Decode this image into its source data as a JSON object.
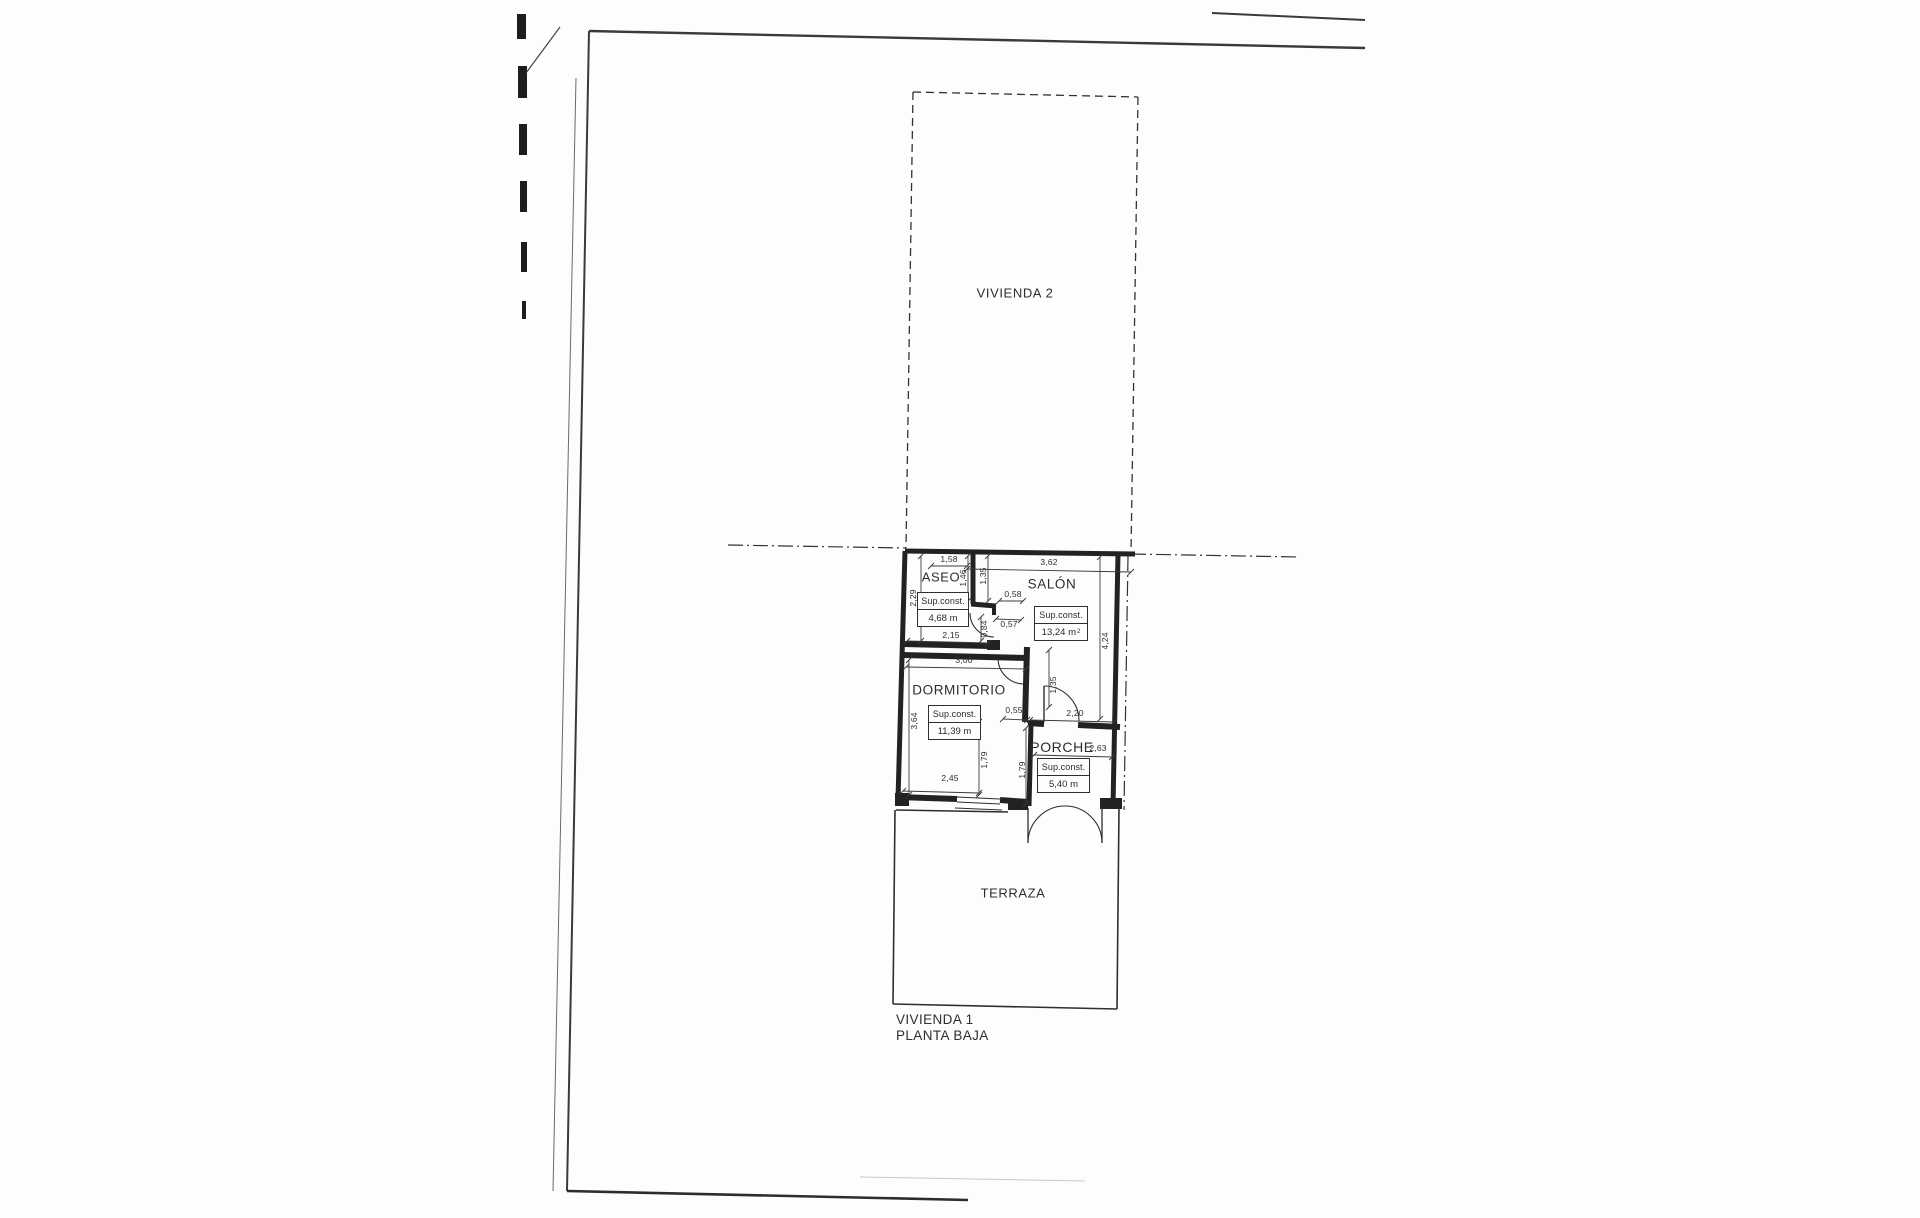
{
  "plan": {
    "upper_unit_label": "VIVIENDA 2",
    "footer": {
      "line1": "VIVIENDA 1",
      "line2": "PLANTA BAJA"
    },
    "sup_label": "Sup.const.",
    "rooms": {
      "aseo": {
        "name": "ASEO",
        "sup_label": "Sup.const.",
        "area": "4,68 m"
      },
      "salon": {
        "name": "SALÓN",
        "sup_label": "Sup.const.",
        "area": "13,24 m",
        "area_exponent": "2"
      },
      "dormitorio": {
        "name": "DORMITORIO",
        "sup_label": "Sup.const.",
        "area": "11,39 m"
      },
      "porche": {
        "name": "PORCHE",
        "sup_label": "Sup.const.",
        "area": "5,40 m"
      },
      "terraza": {
        "name": "TERRAZA"
      }
    },
    "dimensions": {
      "aseo_width": "1,58",
      "salon_width": "3,62",
      "aseo_height": "2,29",
      "aseo_partition_a": "1,46",
      "aseo_partition_b": "1,35",
      "hall_jog_top": "0,58",
      "hall_jog_bottom": "0,57",
      "aseo_door": "0,84",
      "aseo_inner_width": "2,15",
      "salon_height": "4,24",
      "dormitorio_width": "3,00",
      "dormitorio_height": "3,64",
      "hall_stub": "0,55",
      "porche_opening": "2,20",
      "salon_door": "1,35",
      "dormitorio_wall_a": "1,79",
      "porche_wall_b": "1,79",
      "dormitorio_inner_width": "2,45",
      "porche_width": "2,63"
    },
    "colors": {
      "ink": "#2b2b2b",
      "paper": "#fdfdfc"
    }
  }
}
